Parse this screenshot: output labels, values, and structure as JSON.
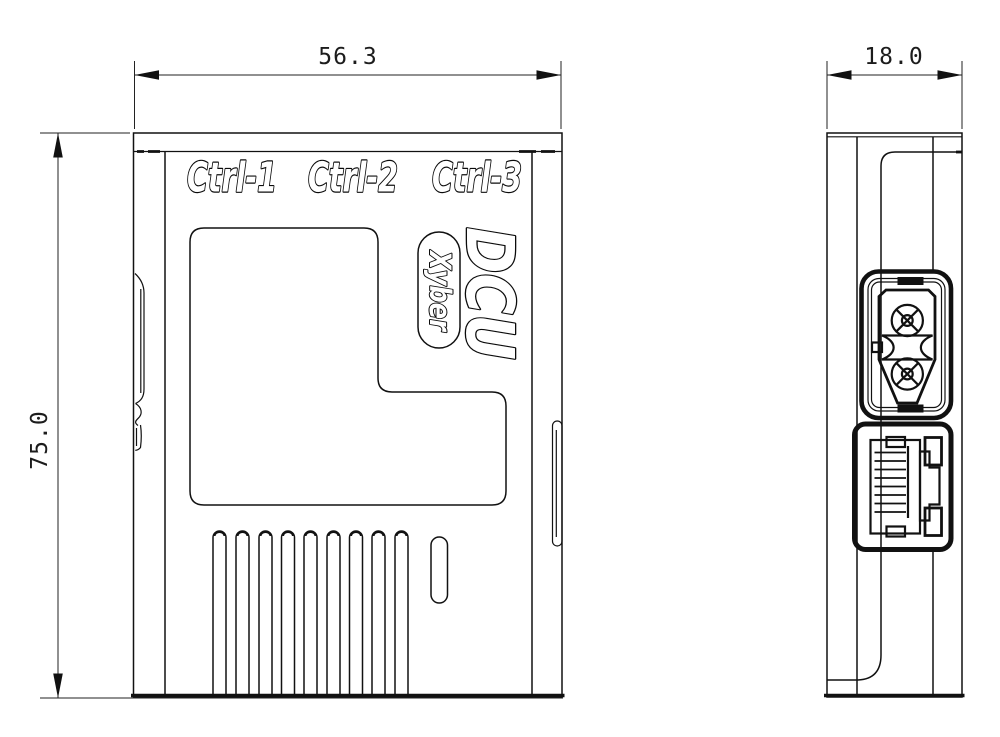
{
  "drawing": {
    "front_view": {
      "port_labels": [
        "Ctrl-1",
        "Ctrl-2",
        "Ctrl-3"
      ],
      "logo": "DCU",
      "brand": "Xyber"
    },
    "dimensions": {
      "width": "56.3",
      "height": "75.0",
      "depth": "18.0"
    },
    "colors": {
      "line": "#111111",
      "background": "#ffffff"
    }
  }
}
